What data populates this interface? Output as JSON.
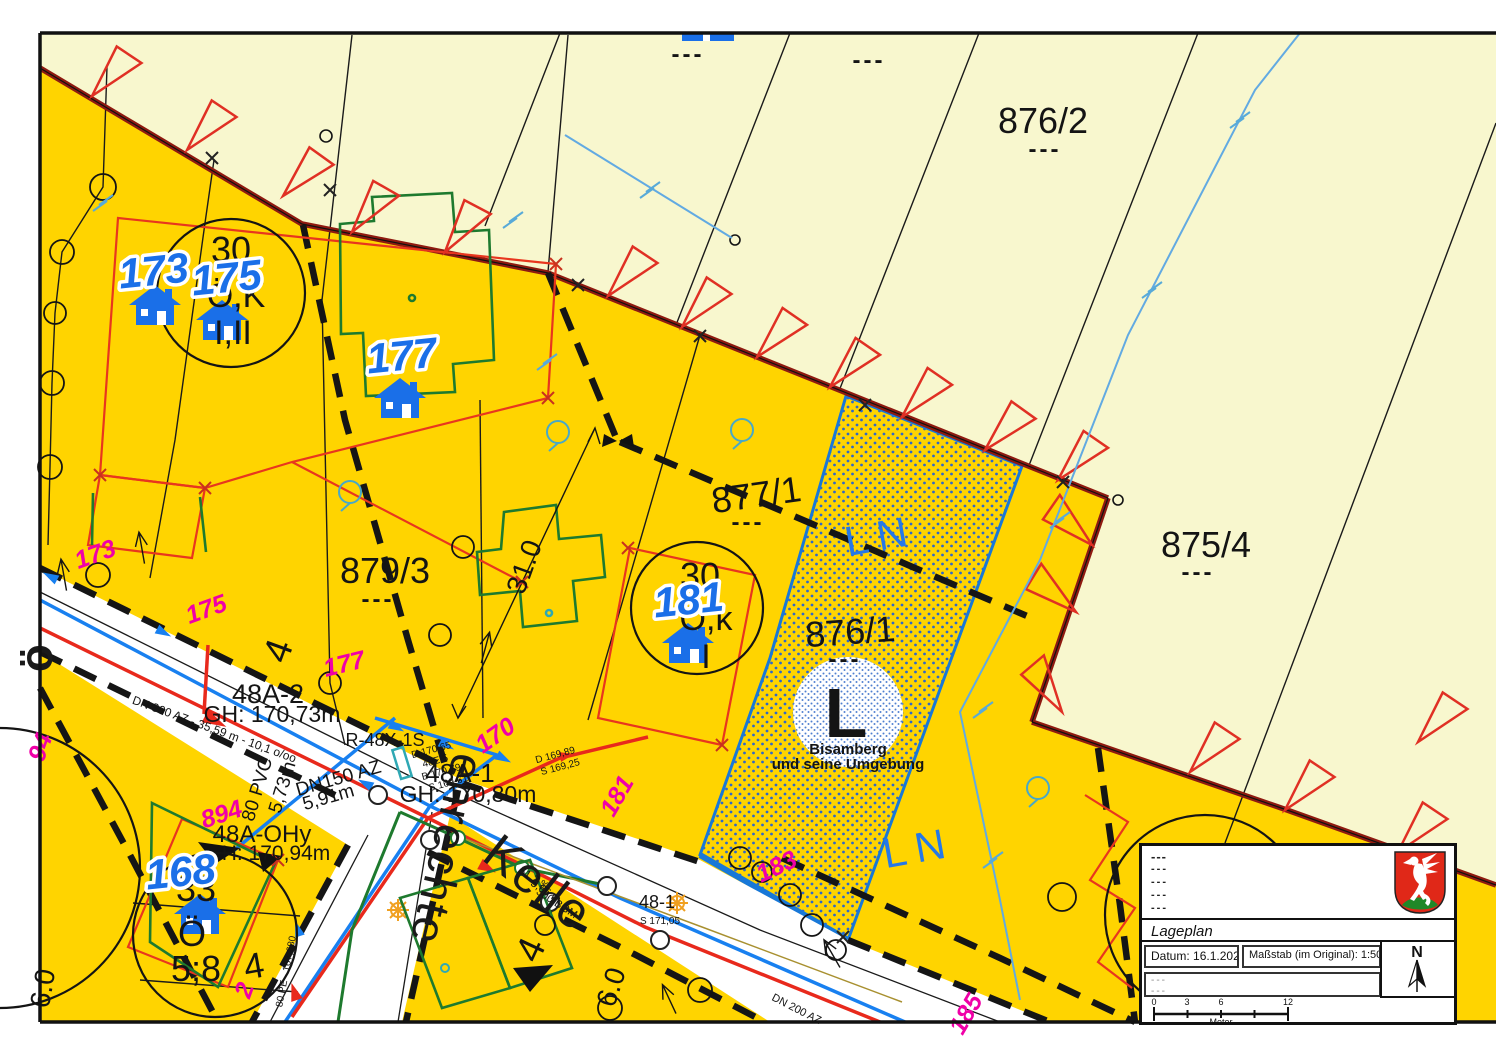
{
  "title": "Lageplan",
  "colors": {
    "bauland_yellow": "#FFD400",
    "gruenland_cream": "#F8F7CE",
    "boundary_darkred": "#8E1A10",
    "parcel_red": "#E8361E",
    "magenta": "#F000A8",
    "label_blue": "#1A6FE8",
    "ln_blue": "#2578E8",
    "water_blue": "#1880F0",
    "stream_lightblue": "#62AAE2",
    "sewer_red": "#E8291C",
    "gas_green": "#1E7A2E",
    "teal": "#2FA8B4",
    "lamp_orange": "#F0A020",
    "line_black": "#141414"
  },
  "legend": {
    "notes": [
      "---",
      "---",
      "---",
      "---",
      "---"
    ],
    "title": "Lageplan",
    "date_label": "Datum:",
    "date_value": "16.1.2026",
    "scale_label": "Maßstab (im Original):",
    "scale_value": "1:500",
    "notes2": [
      "---",
      "---"
    ],
    "north": "N",
    "bar": {
      "t0": "0",
      "t1": "3",
      "t2": "6",
      "t3": "12",
      "unit": "Meter"
    }
  },
  "map": {
    "parcels": [
      "876/2",
      "875/4",
      "877/1",
      "879/3",
      "876/1"
    ],
    "zone_code": "LN",
    "protected_area": {
      "code": "L",
      "name": "Bisamberg und seine Umgebung"
    },
    "houses": [
      {
        "x": 155,
        "y": 307
      },
      {
        "x": 222,
        "y": 322
      },
      {
        "x": 400,
        "y": 400
      },
      {
        "x": 688,
        "y": 645
      },
      {
        "x": 200,
        "y": 916
      }
    ],
    "labels": [
      {
        "t": "876/2",
        "x": 1043,
        "y": 133,
        "s": 36,
        "c": "p",
        "n": "parcel-label-876-2"
      },
      {
        "t": "---",
        "x": 1045,
        "y": 157,
        "s": 24,
        "c": "dsh"
      },
      {
        "t": "875/4",
        "x": 1206,
        "y": 557,
        "s": 36,
        "c": "p",
        "n": "parcel-label-875-4"
      },
      {
        "t": "---",
        "x": 1198,
        "y": 580,
        "s": 24,
        "c": "dsh"
      },
      {
        "t": "877/1",
        "x": 758,
        "y": 507,
        "s": 36,
        "c": "p",
        "r": -8,
        "n": "parcel-label-877-1"
      },
      {
        "t": "---",
        "x": 748,
        "y": 530,
        "s": 24,
        "c": "dsh"
      },
      {
        "t": "879/3",
        "x": 385,
        "y": 583,
        "s": 36,
        "c": "p",
        "n": "parcel-label-879-3"
      },
      {
        "t": "---",
        "x": 378,
        "y": 607,
        "s": 24,
        "c": "dsh"
      },
      {
        "t": "876/1",
        "x": 851,
        "y": 644,
        "s": 36,
        "c": "p",
        "r": -4,
        "n": "parcel-label-876-1"
      },
      {
        "t": "---",
        "x": 845,
        "y": 667,
        "s": 24,
        "c": "dsh"
      },
      {
        "t": "---",
        "x": 688,
        "y": 62,
        "s": 24,
        "c": "dsh"
      },
      {
        "t": "---",
        "x": 869,
        "y": 68,
        "s": 24,
        "c": "dsh"
      },
      {
        "t": "30",
        "x": 231,
        "y": 262,
        "s": 36,
        "c": "ct"
      },
      {
        "t": "Ö,K",
        "x": 236,
        "y": 307,
        "s": 34,
        "c": "ct"
      },
      {
        "t": "I,II",
        "x": 233,
        "y": 344,
        "s": 34,
        "c": "ct"
      },
      {
        "t": "30",
        "x": 700,
        "y": 588,
        "s": 36,
        "c": "ct"
      },
      {
        "t": "Ö,k",
        "x": 706,
        "y": 630,
        "s": 34,
        "c": "ct"
      },
      {
        "t": "I",
        "x": 706,
        "y": 668,
        "s": 34,
        "c": "ct"
      },
      {
        "t": "33",
        "x": 196,
        "y": 901,
        "s": 36,
        "c": "ct"
      },
      {
        "t": "Ö",
        "x": 192,
        "y": 946,
        "s": 36,
        "c": "ct"
      },
      {
        "t": "5;8",
        "x": 196,
        "y": 981,
        "s": 36,
        "c": "ct"
      },
      {
        "t": "4",
        "x": 256,
        "y": 978,
        "s": 36,
        "c": "ct",
        "r": -10
      },
      {
        "t": "173",
        "x": 155,
        "y": 285,
        "s": 42,
        "c": "b",
        "r": -6,
        "n": "house-number-173"
      },
      {
        "t": "175",
        "x": 228,
        "y": 292,
        "s": 42,
        "c": "b",
        "r": -6,
        "n": "house-number-175"
      },
      {
        "t": "177",
        "x": 403,
        "y": 370,
        "s": 42,
        "c": "b",
        "r": -6,
        "n": "house-number-177"
      },
      {
        "t": "181",
        "x": 690,
        "y": 614,
        "s": 42,
        "c": "b",
        "r": -6,
        "n": "house-number-181"
      },
      {
        "t": "168",
        "x": 182,
        "y": 886,
        "s": 42,
        "c": "b",
        "r": -6,
        "n": "house-number-168"
      },
      {
        "t": "LN",
        "x": 883,
        "y": 550,
        "s": 42,
        "c": "ln",
        "r": -10,
        "n": "zone-ln-1"
      },
      {
        "t": "LN",
        "x": 921,
        "y": 862,
        "s": 42,
        "c": "ln",
        "r": -10,
        "n": "zone-ln-2"
      },
      {
        "t": "L",
        "x": 846,
        "y": 737,
        "s": 70,
        "c": "Lbig",
        "n": "protected-area-code"
      },
      {
        "t": "Bisamberg",
        "x": 848,
        "y": 754,
        "s": 15,
        "c": "Lsub"
      },
      {
        "t": "und seine Umgebung",
        "x": 848,
        "y": 769,
        "s": 15,
        "c": "Lsub"
      },
      {
        "t": "enrechte",
        "x": 432,
        "y": 846,
        "s": 46,
        "c": "st",
        "r": 103,
        "n": "street-name-1"
      },
      {
        "t": "Kelle",
        "x": 528,
        "y": 896,
        "s": 50,
        "c": "st",
        "r": 38,
        "n": "street-name-2"
      },
      {
        "t": "ö",
        "x": 52,
        "y": 658,
        "s": 46,
        "c": "st2",
        "r": -90
      },
      {
        "t": "31.0",
        "x": 533,
        "y": 570,
        "s": 28,
        "c": "dim",
        "r": -70
      },
      {
        "t": "6.0",
        "x": 620,
        "y": 990,
        "s": 28,
        "c": "dim",
        "r": -72
      },
      {
        "t": "6.0",
        "x": 52,
        "y": 990,
        "s": 28,
        "c": "dim",
        "r": -80
      },
      {
        "t": "4",
        "x": 290,
        "y": 655,
        "s": 38,
        "c": "dim",
        "r": -70
      },
      {
        "t": "4",
        "x": 542,
        "y": 955,
        "s": 38,
        "c": "dim",
        "r": -65
      },
      {
        "t": "48A-2",
        "x": 268,
        "y": 703,
        "s": 27,
        "c": "t"
      },
      {
        "t": "GH: 170,73m",
        "x": 272,
        "y": 722,
        "s": 23,
        "c": "t"
      },
      {
        "t": "48A-1",
        "x": 460,
        "y": 782,
        "s": 26,
        "c": "t"
      },
      {
        "t": "GH: 170,80m",
        "x": 468,
        "y": 802,
        "s": 23,
        "c": "t"
      },
      {
        "t": "48A-OHy",
        "x": 262,
        "y": 842,
        "s": 24,
        "c": "t"
      },
      {
        "t": "H: 170,94m",
        "x": 276,
        "y": 860,
        "s": 21,
        "c": "t"
      },
      {
        "t": "R-48X-1S",
        "x": 385,
        "y": 746,
        "s": 18,
        "c": "t"
      },
      {
        "t": "DN150 AZ",
        "x": 340,
        "y": 784,
        "s": 19,
        "c": "t",
        "r": -16
      },
      {
        "t": "5,91m",
        "x": 330,
        "y": 803,
        "s": 19,
        "c": "t",
        "r": -16
      },
      {
        "t": "80 PVC",
        "x": 263,
        "y": 791,
        "s": 19,
        "c": "t",
        "r": -73
      },
      {
        "t": "5,73m",
        "x": 288,
        "y": 789,
        "s": 19,
        "c": "t",
        "r": -73
      },
      {
        "t": "48-1",
        "x": 657,
        "y": 908,
        "s": 18,
        "c": "t"
      },
      {
        "t": "DN 300 AZ - 35,59 m - 10,1 o/oo",
        "x": 213,
        "y": 733,
        "s": 12,
        "c": "y",
        "r": 20
      },
      {
        "t": "DN 200 AZ",
        "x": 795,
        "y": 1012,
        "s": 11,
        "c": "y",
        "r": 27
      },
      {
        "t": "D 170,65",
        "x": 432,
        "y": 753,
        "s": 10,
        "c": "y",
        "r": -15
      },
      {
        "t": "48E 5",
        "x": 436,
        "y": 764,
        "s": 10,
        "c": "y",
        "r": -15
      },
      {
        "t": "B 170,79",
        "x": 442,
        "y": 775,
        "s": 10,
        "c": "y",
        "r": -15
      },
      {
        "t": "S 169,61",
        "x": 449,
        "y": 786,
        "s": 10,
        "c": "y",
        "r": -15
      },
      {
        "t": "D 169,89",
        "x": 556,
        "y": 758,
        "s": 10,
        "c": "y",
        "r": -15
      },
      {
        "t": "S 169,25",
        "x": 561,
        "y": 770,
        "s": 10,
        "c": "y",
        "r": -15
      },
      {
        "t": "51,2 ‰",
        "x": 533,
        "y": 882,
        "s": 11,
        "c": "y",
        "r": 33
      },
      {
        "t": "5,66 m",
        "x": 544,
        "y": 894,
        "s": 11,
        "c": "y",
        "r": 33
      },
      {
        "t": "300 BGM",
        "x": 555,
        "y": 906,
        "s": 11,
        "c": "y",
        "r": 33
      },
      {
        "t": "S 171,05",
        "x": 660,
        "y": 924,
        "s": 10,
        "c": "y"
      },
      {
        "t": "80 PE - 167,680",
        "x": 289,
        "y": 972,
        "s": 10,
        "c": "y",
        "r": -79
      },
      {
        "t": "173",
        "x": 98,
        "y": 562,
        "s": 25,
        "c": "m",
        "r": -20
      },
      {
        "t": "175",
        "x": 209,
        "y": 617,
        "s": 25,
        "c": "m",
        "r": -20
      },
      {
        "t": "177",
        "x": 346,
        "y": 672,
        "s": 25,
        "c": "m",
        "r": -14
      },
      {
        "t": "170",
        "x": 500,
        "y": 742,
        "s": 25,
        "c": "m",
        "r": -35
      },
      {
        "t": "181",
        "x": 624,
        "y": 800,
        "s": 25,
        "c": "m",
        "r": -60
      },
      {
        "t": "183",
        "x": 780,
        "y": 874,
        "s": 25,
        "c": "m",
        "r": -25
      },
      {
        "t": "185",
        "x": 973,
        "y": 1018,
        "s": 25,
        "c": "m",
        "r": -60
      },
      {
        "t": "894",
        "x": 224,
        "y": 822,
        "s": 25,
        "c": "m",
        "r": -18
      },
      {
        "t": "2",
        "x": 252,
        "y": 993,
        "s": 25,
        "c": "m",
        "r": -70
      },
      {
        "t": "94",
        "x": 48,
        "y": 750,
        "s": 25,
        "c": "m",
        "r": -70
      }
    ]
  }
}
